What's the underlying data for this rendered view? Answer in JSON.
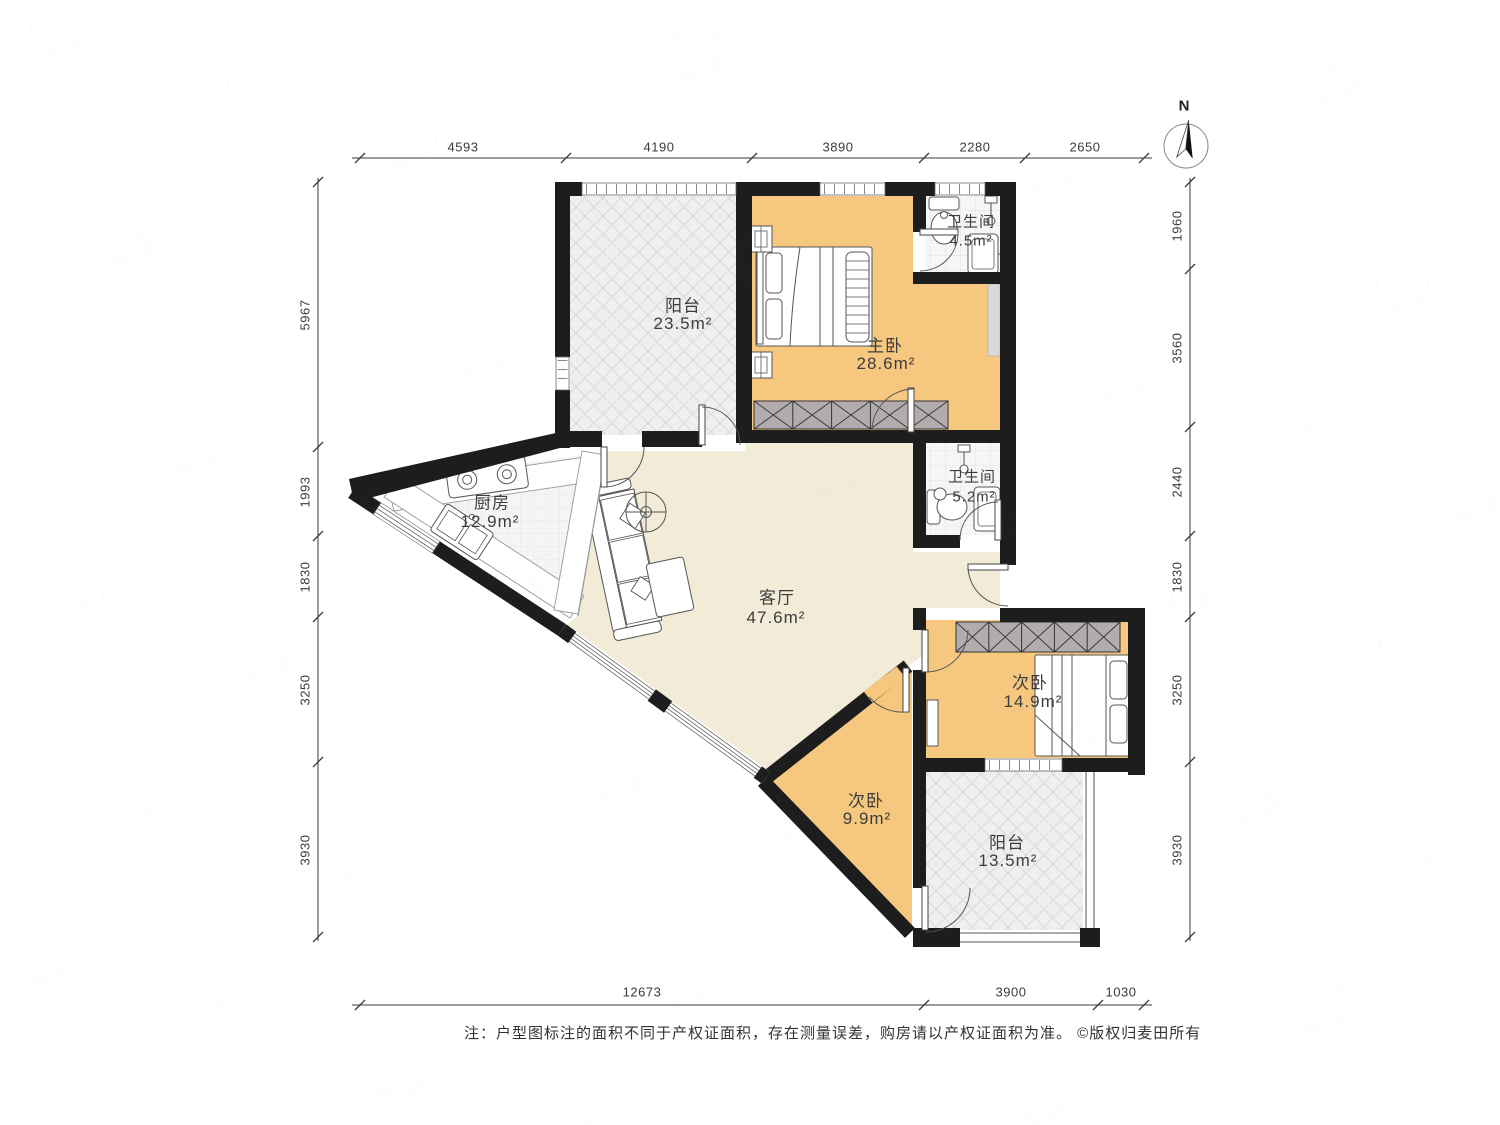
{
  "compass": {
    "north_label": "N"
  },
  "rooms": {
    "balcony_top": {
      "label": "阳台",
      "area": "23.5m²"
    },
    "master": {
      "label": "主卧",
      "area": "28.6m²"
    },
    "bath_top": {
      "label": "卫生间",
      "area": "4.5m²"
    },
    "bath_mid": {
      "label": "卫生间",
      "area": "5.2m²"
    },
    "kitchen": {
      "label": "厨房",
      "area": "12.9m²"
    },
    "living": {
      "label": "客厅",
      "area": "47.6m²"
    },
    "bed_right": {
      "label": "次卧",
      "area": "14.9m²"
    },
    "bed_bottom": {
      "label": "次卧",
      "area": "9.9m²"
    },
    "balcony_bottom": {
      "label": "阳台",
      "area": "13.5m²"
    }
  },
  "dimensions": {
    "top": [
      "4593",
      "4190",
      "3890",
      "2280",
      "2650"
    ],
    "left": [
      "5967",
      "1993",
      "1830",
      "3250",
      "3930"
    ],
    "right": [
      "1960",
      "3560",
      "2440",
      "1830",
      "3250",
      "3930"
    ],
    "bottom": [
      "12673",
      "3900",
      "1030"
    ]
  },
  "note": {
    "text": "注：户型图标注的面积不同于产权证面积，存在测量误差，购房请以产权证面积为准。 ©版权归麦田所有"
  },
  "colors": {
    "wall": "#1d1d1d",
    "bedroom_floor": "#f6c77e",
    "living_floor": "#f2ebd8",
    "balcony_floor": "#efefef",
    "wardrobe_gray": "#b3acac"
  }
}
